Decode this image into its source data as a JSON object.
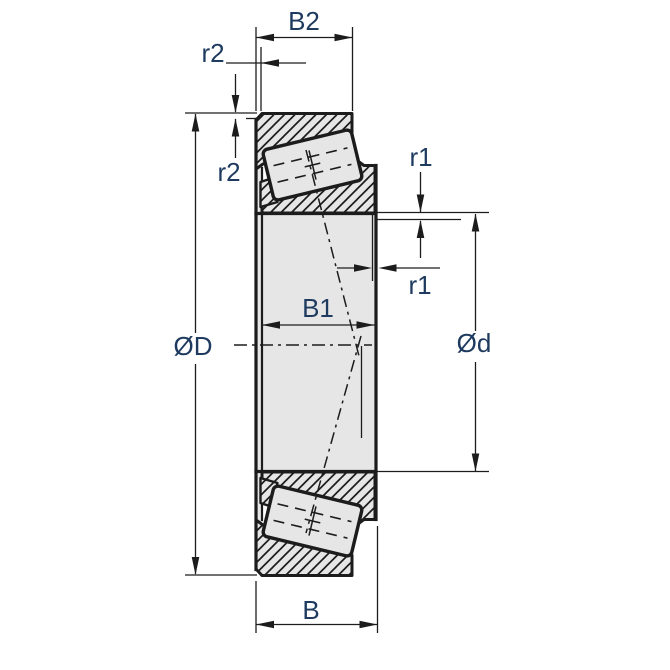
{
  "diagram": {
    "type": "technical-drawing",
    "subject": "tapered-roller-bearing-cross-section",
    "labels": {
      "b2": "B2",
      "r2_width": "r2",
      "r2_height": "r2",
      "r1_height": "r1",
      "r1_width": "r1",
      "outer_diameter": "ØD",
      "bore_diameter": "Ød",
      "b1": "B1",
      "b": "B"
    },
    "colors": {
      "background": "#ffffff",
      "line": "#1c1c1c",
      "body_fill": "#e6e6e6",
      "label_text": "#1e3a5f"
    }
  }
}
